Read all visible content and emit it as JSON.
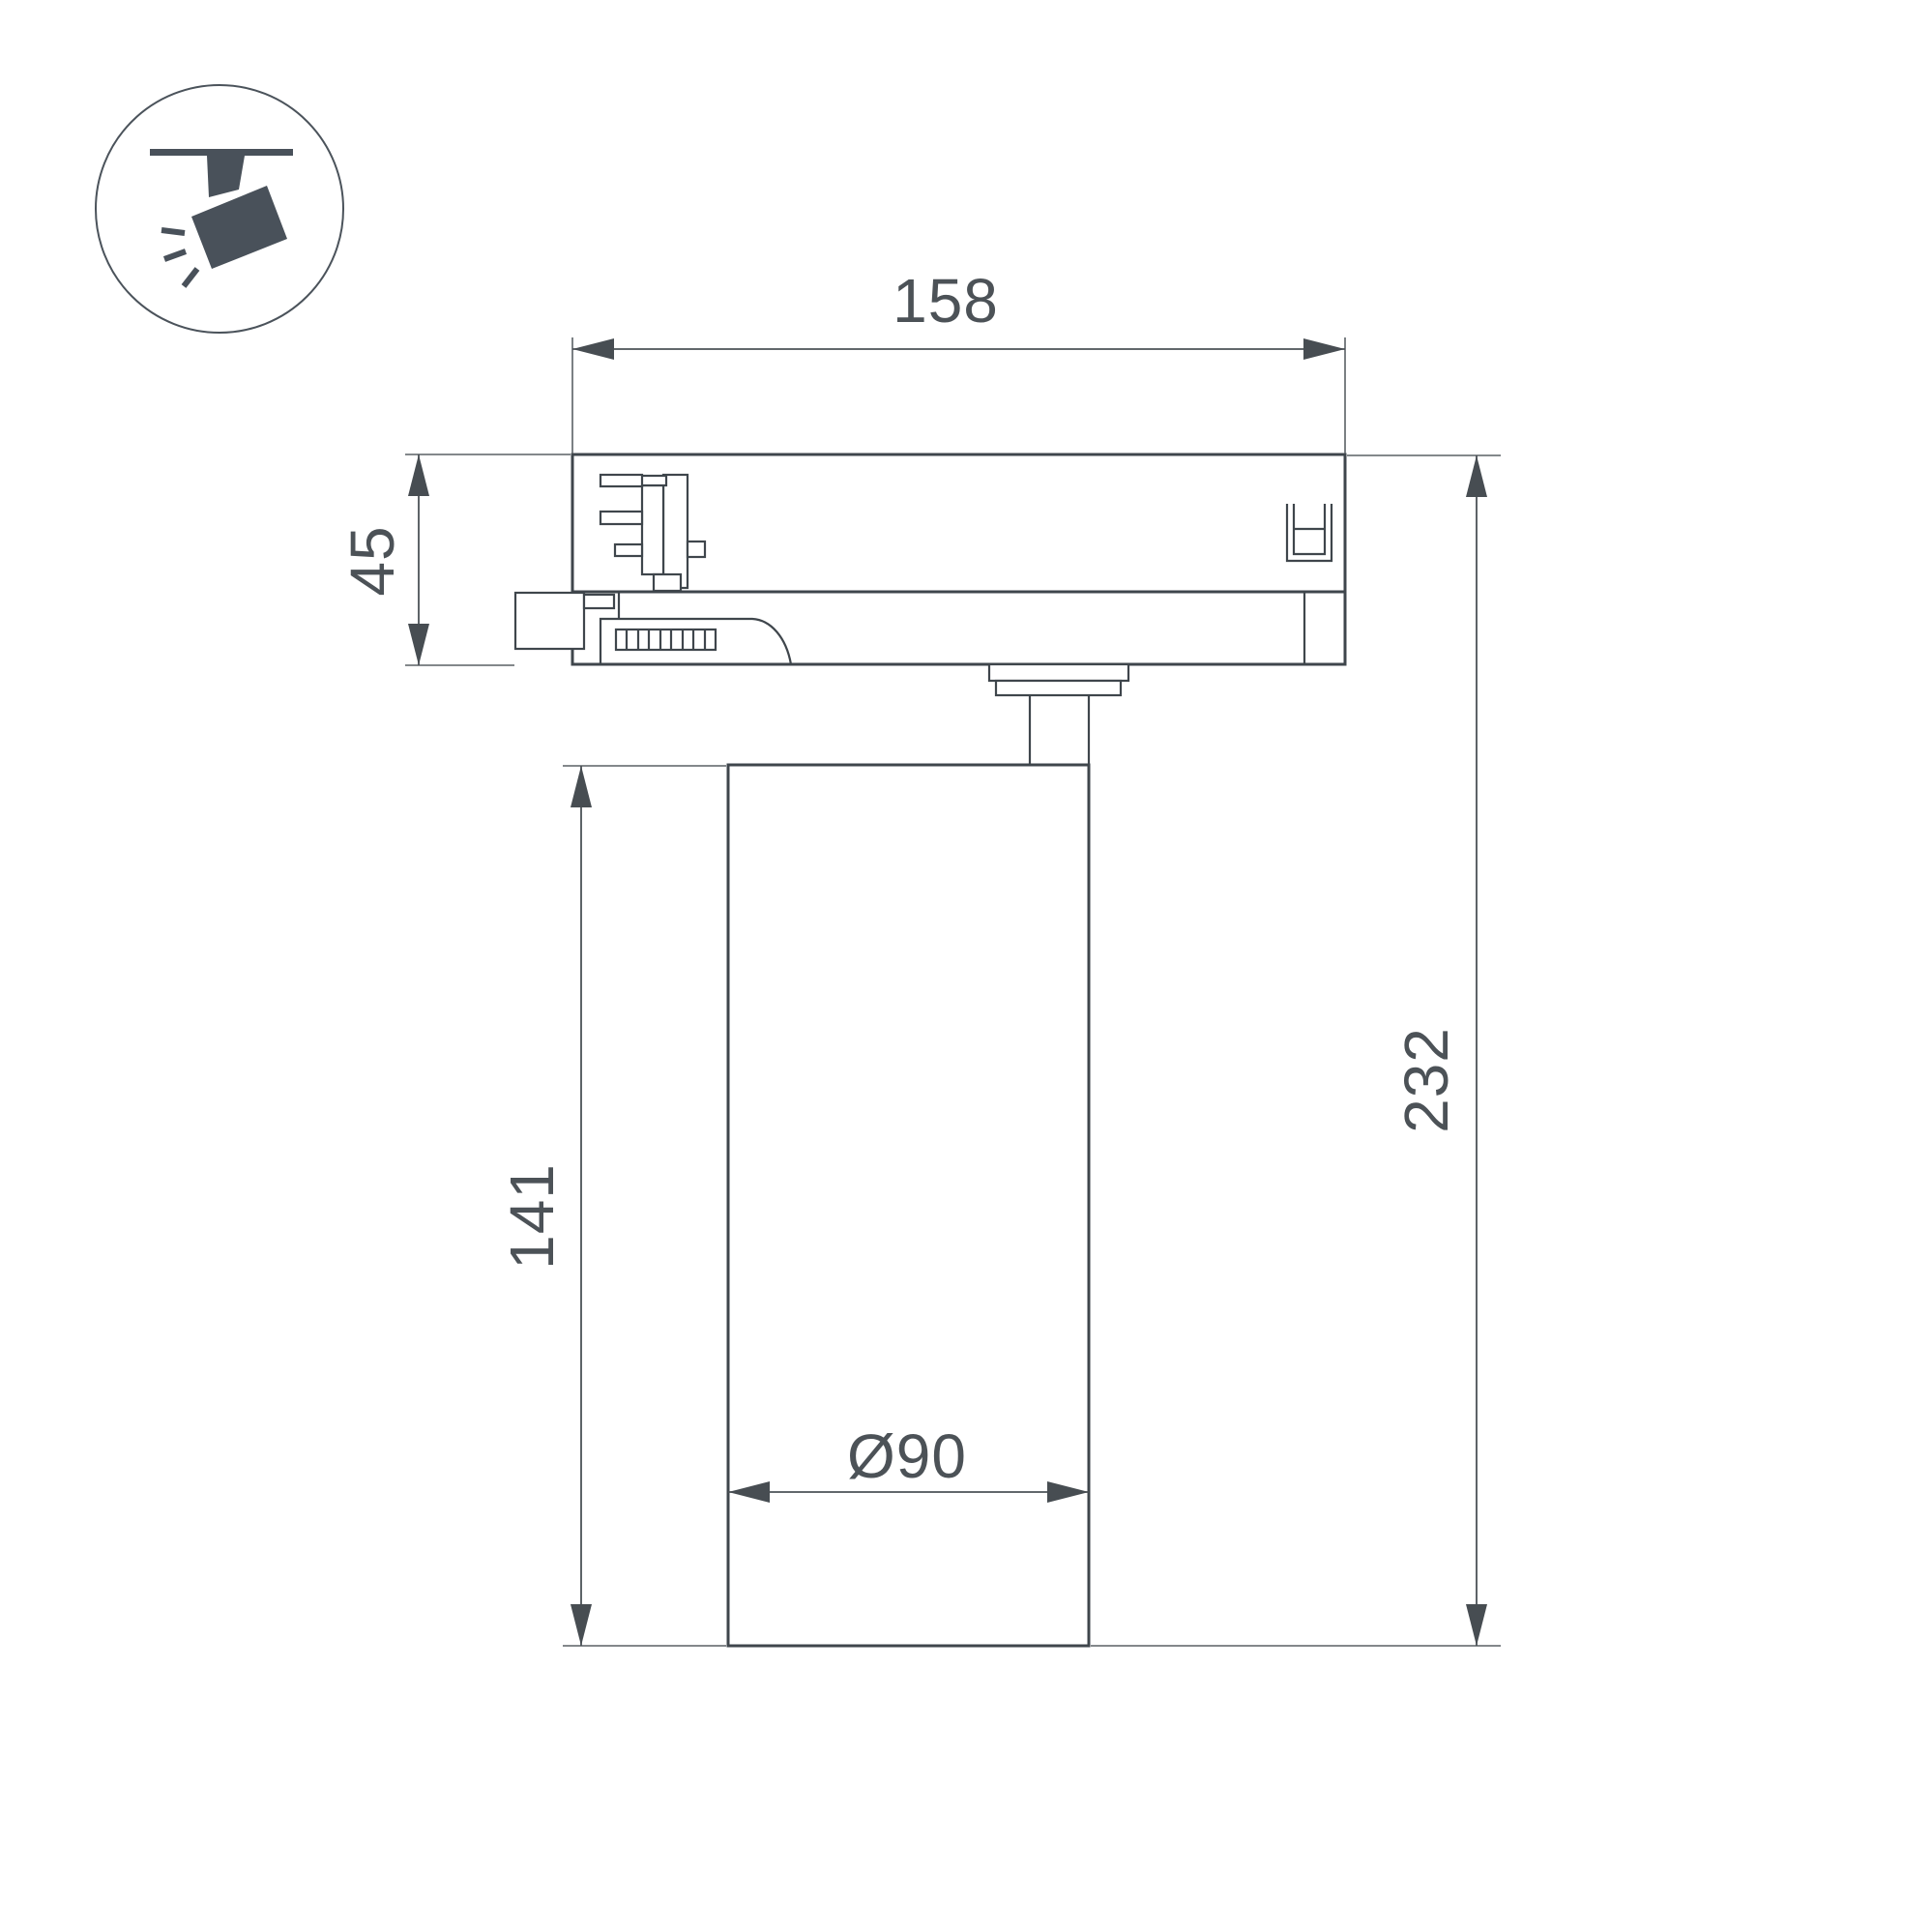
{
  "page": {
    "background": "#ffffff",
    "type": "technical-dimension-drawing"
  },
  "icon": {
    "name": "track-spotlight",
    "fill_color": "#49515a"
  },
  "dimensions": {
    "top_width": "158",
    "adapter_height": "45",
    "body_height": "141",
    "overall_height": "232",
    "body_diameter": "Ø90"
  },
  "colors": {
    "outline": "#3f464c",
    "dimension_lines": "#4c5257",
    "dimension_text": "#4c5257"
  }
}
